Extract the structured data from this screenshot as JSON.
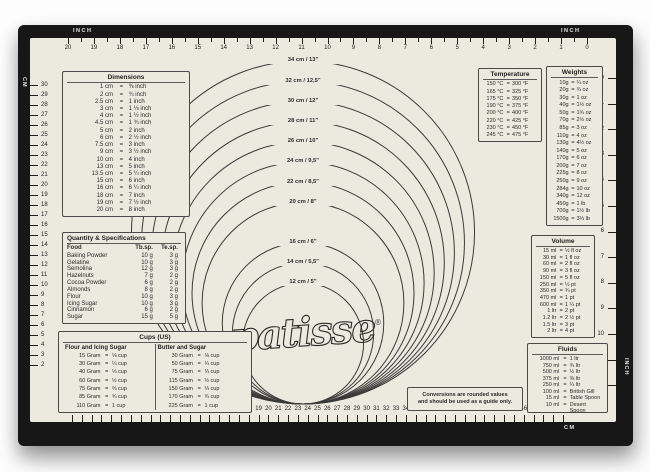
{
  "brand": {
    "name": "patisse",
    "mark": "®"
  },
  "note": {
    "line1": "Conversions are rounded values",
    "line2": "and should be used as a guide only."
  },
  "circles": {
    "items": [
      {
        "cm": 34,
        "label": "34 cm / 13\""
      },
      {
        "cm": 32,
        "label": "32 cm / 12,5\""
      },
      {
        "cm": 30,
        "label": "30 cm / 12\""
      },
      {
        "cm": 28,
        "label": "28 cm / 11\""
      },
      {
        "cm": 26,
        "label": "26 cm / 10\""
      },
      {
        "cm": 24,
        "label": "24 cm / 9,5\""
      },
      {
        "cm": 22,
        "label": "22 cm / 8,5\""
      },
      {
        "cm": 20,
        "label": "20 cm / 8\""
      },
      {
        "cm": 16,
        "label": "16 cm / 6\""
      },
      {
        "cm": 14,
        "label": "14 cm / 5,5\""
      },
      {
        "cm": 12,
        "label": "12 cm / 5\""
      }
    ]
  },
  "rulers": {
    "top": {
      "left_label": "INCH",
      "right_label": "INCH",
      "numbers": [
        20,
        19,
        18,
        17,
        16,
        15,
        14,
        13,
        12,
        11,
        10,
        9,
        8,
        7,
        6,
        5,
        4,
        3,
        2,
        1,
        0
      ]
    },
    "bottom": {
      "unit_label": "CM",
      "numbers": [
        0,
        1,
        2,
        3,
        4,
        5,
        6,
        7,
        8,
        9,
        10,
        11,
        12,
        13,
        14,
        15,
        16,
        17,
        18,
        19,
        20,
        21,
        22,
        23,
        24,
        25,
        26,
        27,
        28,
        29,
        30,
        31,
        32,
        33,
        34,
        35,
        36,
        37,
        38,
        39,
        40,
        41,
        42,
        43,
        44,
        45,
        46,
        47,
        48,
        49,
        50
      ]
    },
    "left": {
      "unit_label": "CM",
      "numbers": [
        30,
        29,
        28,
        27,
        26,
        25,
        24,
        23,
        22,
        21,
        20,
        19,
        18,
        17,
        16,
        15,
        14,
        13,
        12,
        11,
        10,
        9,
        8,
        7,
        6,
        5,
        4,
        3,
        2
      ]
    },
    "right": {
      "unit_label": "INCH",
      "numbers": [
        0,
        1,
        2,
        3,
        4,
        5,
        6,
        7,
        8,
        9,
        10,
        11,
        12
      ]
    }
  },
  "tables": {
    "dimensions": {
      "title": "Dimensions",
      "rows": [
        [
          "1 cm",
          "⅜ inch"
        ],
        [
          "2 cm",
          "¾ inch"
        ],
        [
          "2.5 cm",
          "1 inch"
        ],
        [
          "3 cm",
          "1 ⅛ inch"
        ],
        [
          "4 cm",
          "1 ½ inch"
        ],
        [
          "4.5 cm",
          "1 ¾ inch"
        ],
        [
          "5 cm",
          "2 inch"
        ],
        [
          "6 cm",
          "2 ½ inch"
        ],
        [
          "7.5 cm",
          "3 inch"
        ],
        [
          "9 cm",
          "3 ½ inch"
        ],
        [
          "10 cm",
          "4 inch"
        ],
        [
          "13 cm",
          "5 inch"
        ],
        [
          "13.5 cm",
          "5 ¼ inch"
        ],
        [
          "15 cm",
          "6 inch"
        ],
        [
          "16 cm",
          "6 ¼ inch"
        ],
        [
          "18 cm",
          "7 inch"
        ],
        [
          "19 cm",
          "7 ½ inch"
        ],
        [
          "20 cm",
          "8 inch"
        ]
      ]
    },
    "quantity": {
      "title": "Quantity & Specifications",
      "headers": [
        "Food",
        "Tb.sp.",
        "Te.sp."
      ],
      "rows": [
        [
          "Baking Powder",
          "10 g",
          "3 g"
        ],
        [
          "Gelatine",
          "10 g",
          "3 g"
        ],
        [
          "Semolina",
          "12 g",
          "3 g"
        ],
        [
          "Hazelnuts",
          "7 g",
          "2 g"
        ],
        [
          "Cocoa Powder",
          "6 g",
          "2 g"
        ],
        [
          "Almonds",
          "8 g",
          "2 g"
        ],
        [
          "Flour",
          "10 g",
          "3 g"
        ],
        [
          "Icing Sugar",
          "10 g",
          "3 g"
        ],
        [
          "Cinnamon",
          "6 g",
          "2 g"
        ],
        [
          "Sugar",
          "15 g",
          "5 g"
        ]
      ]
    },
    "cups": {
      "title": "Cups (US)",
      "left_header": "Flour and Icing Sugar",
      "right_header": "Butter and Sugar",
      "left_rows": [
        [
          "15 Gram",
          "⅛ cup"
        ],
        [
          "30 Gram",
          "¼ cup"
        ],
        [
          "40 Gram",
          "⅓ cup"
        ],
        [
          "60 Gram",
          "½ cup"
        ],
        [
          "75 Gram",
          "⅔ cup"
        ],
        [
          "85 Gram",
          "¾ cup"
        ],
        [
          "110 Gram",
          "1 cup"
        ]
      ],
      "right_rows": [
        [
          "30 Gram",
          "⅛ cup"
        ],
        [
          "50 Gram",
          "¼ cup"
        ],
        [
          "75 Gram",
          "⅓ cup"
        ],
        [
          "115 Gram",
          "½ cup"
        ],
        [
          "150 Gram",
          "⅔ cup"
        ],
        [
          "170 Gram",
          "¾ cup"
        ],
        [
          "225 Gram",
          "1 cup"
        ]
      ]
    },
    "temperature": {
      "title": "Temperature",
      "rows": [
        [
          "150 °C",
          "300 °F"
        ],
        [
          "165 °C",
          "325 °F"
        ],
        [
          "175 °C",
          "350 °F"
        ],
        [
          "190 °C",
          "375 °F"
        ],
        [
          "200 °C",
          "400 °F"
        ],
        [
          "220 °C",
          "425 °F"
        ],
        [
          "230 °C",
          "450 °F"
        ],
        [
          "245 °C",
          "475 °F"
        ]
      ]
    },
    "weights": {
      "title": "Weights",
      "rows": [
        [
          "10g",
          "¼ oz"
        ],
        [
          "20g",
          "¾ oz"
        ],
        [
          "30g",
          "1 oz"
        ],
        [
          "40g",
          "1½ oz"
        ],
        [
          "50g",
          "1¾ oz"
        ],
        [
          "70g",
          "2½ oz"
        ],
        [
          "85g",
          "3 oz"
        ],
        [
          "110g",
          "4 oz"
        ],
        [
          "130g",
          "4½ oz"
        ],
        [
          "140g",
          "5 oz"
        ],
        [
          "170g",
          "6 oz"
        ],
        [
          "200g",
          "7 oz"
        ],
        [
          "225g",
          "8 oz"
        ],
        [
          "250g",
          "9 oz"
        ],
        [
          "284g",
          "10 oz"
        ],
        [
          "340g",
          "12 oz"
        ],
        [
          "450g",
          "1 lb"
        ],
        [
          "700g",
          "1½ lb"
        ],
        [
          "1500g",
          "3⅓ lb"
        ]
      ]
    },
    "volume": {
      "title": "Volume",
      "rows": [
        [
          "15 ml",
          "½ fl oz"
        ],
        [
          "30 ml",
          "1 fl oz"
        ],
        [
          "60 ml",
          "2 fl oz"
        ],
        [
          "90 ml",
          "3 fl oz"
        ],
        [
          "150 ml",
          "5 fl oz"
        ],
        [
          "250 ml",
          "½ pt"
        ],
        [
          "350 ml",
          "¾ pt"
        ],
        [
          "470 ml",
          "1 pt"
        ],
        [
          "600 ml",
          "1 ¼ pt"
        ],
        [
          "1 ltr",
          "2 pt"
        ],
        [
          "1.2 ltr",
          "2 ½ pt"
        ],
        [
          "1.5 ltr",
          "3 pt"
        ],
        [
          "2 ltr",
          "4 pt"
        ]
      ]
    },
    "fluids": {
      "title": "Fluids",
      "rows": [
        [
          "1000 ml",
          "1 ltr"
        ],
        [
          "750 ml",
          "¾ ltr"
        ],
        [
          "500 ml",
          "½ ltr"
        ],
        [
          "375 ml",
          "⅜ ltr"
        ],
        [
          "250 ml",
          "¼ ltr"
        ],
        [
          "100 ml",
          "British Gill"
        ],
        [
          "15 ml",
          "Table Spoon"
        ],
        [
          "10 ml",
          "Desert Spoon"
        ]
      ]
    }
  }
}
